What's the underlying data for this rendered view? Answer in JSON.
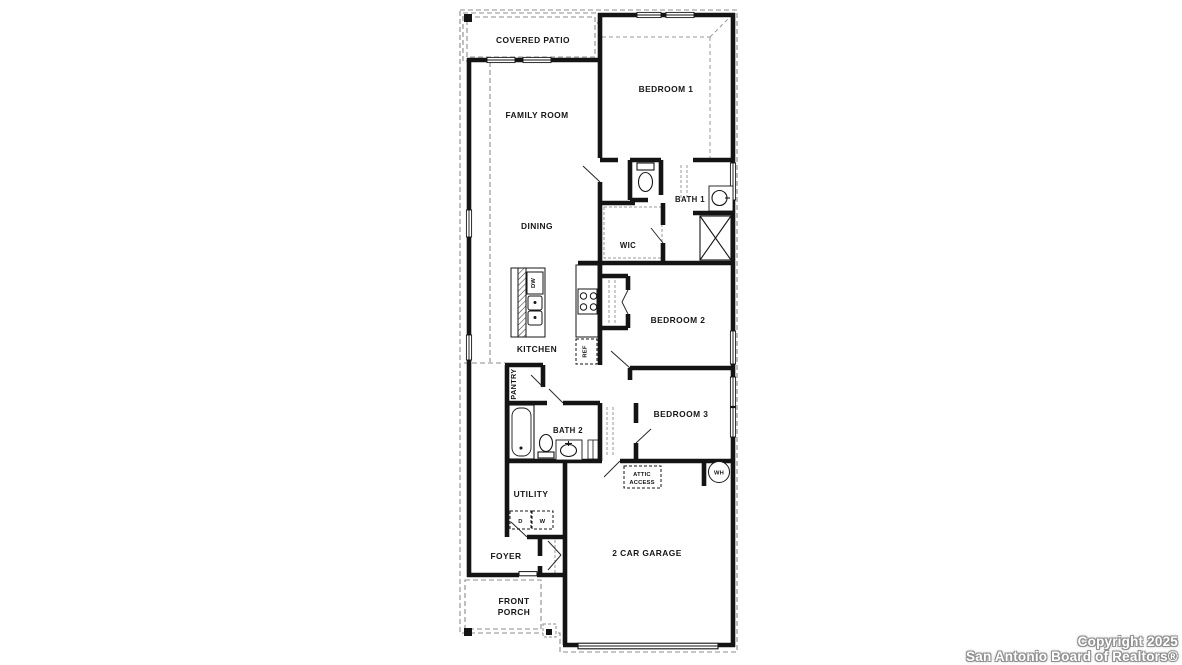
{
  "watermark": {
    "line1": "Copyright 2025",
    "line2": "San Antonio Board of Realtors®"
  },
  "labels": {
    "covered_patio": "COVERED PATIO",
    "family_room": "FAMILY ROOM",
    "bedroom1": "BEDROOM 1",
    "bath1": "BATH 1",
    "wic": "WIC",
    "dining": "DINING",
    "kitchen": "KITCHEN",
    "dishwasher": "DW",
    "refrigerator": "REF",
    "bedroom2": "BEDROOM 2",
    "pantry": "PANTRY",
    "bath2": "BATH 2",
    "bedroom3": "BEDROOM 3",
    "attic_line1": "ATTIC",
    "attic_line2": "ACCESS",
    "water_heater": "WH",
    "utility": "UTILITY",
    "dryer": "D",
    "washer": "W",
    "foyer": "FOYER",
    "garage": "2 CAR GARAGE",
    "porch_line1": "FRONT",
    "porch_line2": "PORCH"
  },
  "colors": {
    "wall": "#141414",
    "dashed_line": "#8c8c8c",
    "background": "#ffffff",
    "watermark_fill": "#ffffff",
    "watermark_outline": "#8f8f8f"
  }
}
